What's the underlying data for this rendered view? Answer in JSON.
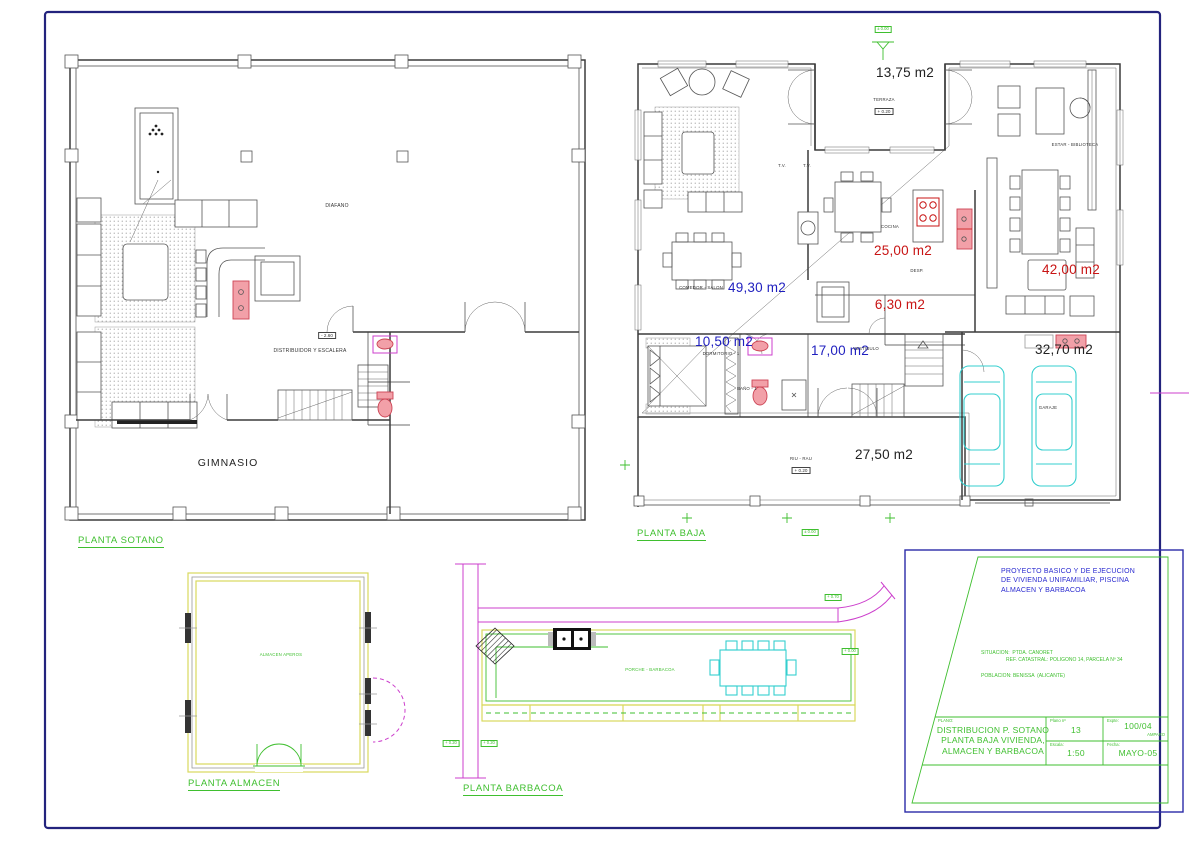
{
  "sotano": {
    "title": "PLANTA SOTANO",
    "labels": {
      "diafano": "DIAFANO",
      "distribuidor": "DISTRIBUIDOR Y ESCALERA",
      "gimnasio": "GIMNASIO",
      "level": "- 2.60"
    }
  },
  "baja": {
    "title": "PLANTA BAJA",
    "levels": {
      "top": "± 0.00",
      "terraza": "+ 0.20",
      "riurau": "+ 0.20",
      "bottom": "± 0.00"
    },
    "rooms": {
      "terraza": "TERRAZA",
      "cocina": "COCINA",
      "desp": "DESP.",
      "estar": "ESTAR  -  BIBLIOTECA",
      "comedor": "COMEDOR - SALON",
      "dormitorio": "DORMITORIO - 1",
      "vestibulo": "VESTIBULO",
      "bano": "BAÑO - 1",
      "garaje": "GARAJE",
      "riurau": "RIU - RAU",
      "tv1": "T.V.",
      "tv2": "T.V."
    },
    "areas": {
      "terraza": "13,75 m2",
      "cocina": "25,00 m2",
      "desp": "6,30 m2",
      "estar": "42,00 m2",
      "comedor": "49,30 m2",
      "dormitorio": "10,50 m2",
      "vestibulo": "17,00 m2",
      "garaje": "32,70 m2",
      "riurau": "27,50 m2"
    }
  },
  "almacen": {
    "title": "PLANTA ALMACEN",
    "room": "ALMACEN APEROS"
  },
  "barbacoa": {
    "title": "PLANTA BARBACOA",
    "room": "PORCHE  -  BARBACOA",
    "levels": {
      "top": "+ 0.70",
      "right": "+ 0.00",
      "left1": "+ 0.20",
      "left2": "+ 0.20"
    }
  },
  "title_block": {
    "project": "PROYECTO BASICO Y DE EJECUCION\nDE VIVIENDA UNIFAMILIAR, PISCINA\nALMACEN Y BARBACOA",
    "situacion": "SITUACION:  PTDA. CANORET\n                  REF. CATASTRAL: POLIGONO 14, PARCELA Nº 34",
    "poblacion": "POBLACION: BENISSA  (ALICANTE)",
    "plano_label": "PLANO:",
    "plano_title": "DISTRIBUCION P. SOTANO\nPLANTA BAJA VIVIENDA,\nALMACEN Y BARBACOA",
    "num_label": "Plano nº",
    "num": "13",
    "expte_label": "Expte:",
    "expte": "100/04",
    "expte_sub": "AMPARO",
    "escala_label": "Escala:",
    "escala": "1:50",
    "fecha_label": "Fecha:",
    "fecha": "MAYO-05"
  },
  "colors": {
    "area_blue": "#1f1fbf",
    "area_red": "#c81414",
    "cad_green": "#3fbf2f",
    "magenta": "#cc3fcc",
    "cyan": "#35cfcf",
    "yellow": "#d9d95e",
    "fixture_pink": "#f2a0a8",
    "border_navy": "#23237d"
  }
}
